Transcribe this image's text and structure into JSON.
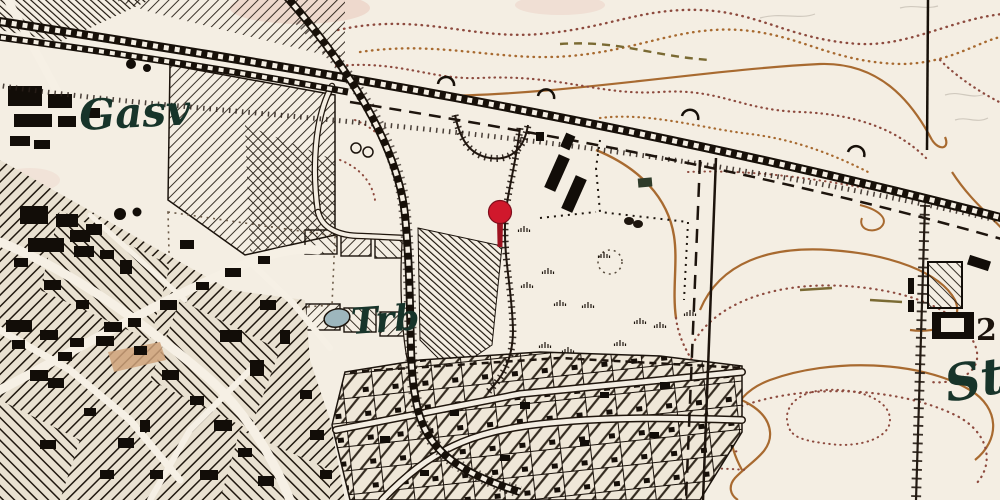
{
  "map": {
    "type": "historical-topographic-map",
    "labels": {
      "gasworks": "Gasv",
      "field": "Trb",
      "station": "St",
      "elevation": "2"
    },
    "marker": {
      "name": "location-pin",
      "x": 500,
      "y": 213
    },
    "colors": {
      "paper": "#f4eee3",
      "ink": "#1c140d",
      "contour": "#a86a30",
      "contour_dark": "#8d4a3e",
      "contour_olive": "#7a6a33",
      "pin_red": "#d0182c",
      "pin_stem": "#9e1220",
      "pond_blue": "#9db6bd",
      "label_green": "#17342a",
      "tint_pink": "#e8c4b8"
    }
  }
}
